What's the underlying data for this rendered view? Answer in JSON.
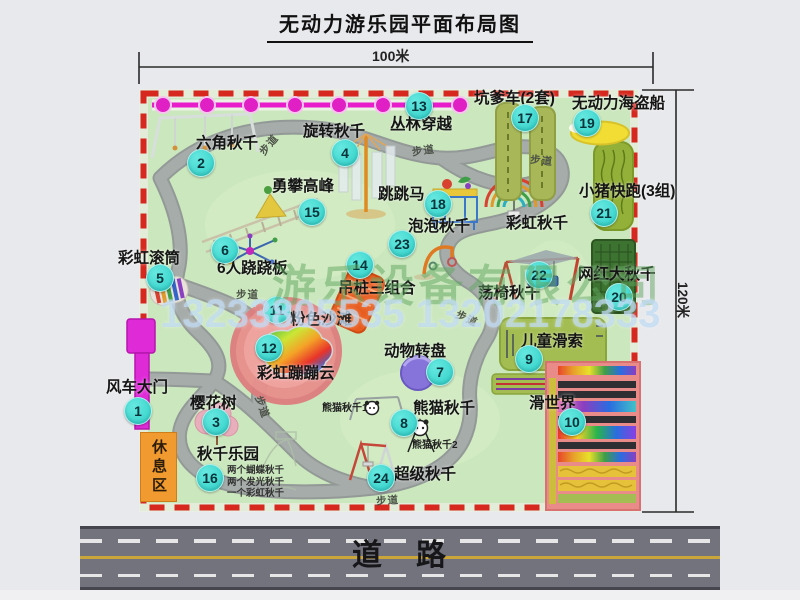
{
  "title": "无动力游乐园平面布局图",
  "dimensions": {
    "width": "100米",
    "height": "120米"
  },
  "road": {
    "label": "道　路"
  },
  "watermarks": {
    "company": "游乐设备有限公司",
    "phones": "13233805535 13202178333"
  },
  "rest_area": {
    "label": "休息区"
  },
  "swing_notes": {
    "x": 227,
    "y": 466,
    "lines": [
      "两个蝴蝶秋千",
      "两个发光秋千",
      "一个彩虹秋千"
    ]
  },
  "small_labels": [
    {
      "text": "熊猫秋千1",
      "x": 322,
      "y": 404
    },
    {
      "text": "熊猫秋千2",
      "x": 412,
      "y": 441
    }
  ],
  "path_labels": [
    {
      "text": "步道",
      "x": 258,
      "y": 140,
      "rot": -50
    },
    {
      "text": "步道",
      "x": 412,
      "y": 146,
      "rot": -8
    },
    {
      "text": "步道",
      "x": 530,
      "y": 156,
      "rot": 6
    },
    {
      "text": "步道",
      "x": 236,
      "y": 290,
      "rot": 0
    },
    {
      "text": "步道",
      "x": 250,
      "y": 402,
      "rot": 70
    },
    {
      "text": "步道",
      "x": 455,
      "y": 314,
      "rot": 25
    },
    {
      "text": "步道",
      "x": 376,
      "y": 496,
      "rot": -4
    }
  ],
  "attractions": [
    {
      "num": "1",
      "name": "风车大门",
      "lx": 106,
      "ly": 380,
      "bx": 137,
      "by": 410
    },
    {
      "num": "2",
      "name": "六角秋千",
      "lx": 196,
      "ly": 136,
      "bx": 200,
      "by": 162
    },
    {
      "num": "3",
      "name": "樱花树",
      "lx": 190,
      "ly": 396,
      "bx": 215,
      "by": 421
    },
    {
      "num": "4",
      "name": "旋转秋千",
      "lx": 303,
      "ly": 124,
      "bx": 344,
      "by": 152
    },
    {
      "num": "5",
      "name": "彩虹滚筒",
      "lx": 118,
      "ly": 251,
      "bx": 159,
      "by": 277
    },
    {
      "num": "6",
      "name": "6人跷跷板",
      "lx": 217,
      "ly": 261,
      "bx": 224,
      "by": 249
    },
    {
      "num": "7",
      "name": "动物转盘",
      "lx": 384,
      "ly": 344,
      "bx": 439,
      "by": 371
    },
    {
      "num": "8",
      "name": "熊猫秋千",
      "lx": 413,
      "ly": 401,
      "bx": 403,
      "by": 422
    },
    {
      "num": "9",
      "name": "儿童滑索",
      "lx": 521,
      "ly": 334,
      "bx": 528,
      "by": 358
    },
    {
      "num": "10",
      "name": "滑世界",
      "lx": 529,
      "ly": 396,
      "bx": 571,
      "by": 421
    },
    {
      "num": "11",
      "name": "粉色沙滩",
      "lx": 290,
      "ly": 312,
      "bx": 276,
      "by": 309
    },
    {
      "num": "12",
      "name": "彩虹蹦蹦云",
      "lx": 257,
      "ly": 366,
      "bx": 268,
      "by": 347
    },
    {
      "num": "13",
      "name": "丛林穿越",
      "lx": 390,
      "ly": 117,
      "bx": 418,
      "by": 105
    },
    {
      "num": "14",
      "name": "吊桩三组合",
      "lx": 338,
      "ly": 281,
      "bx": 359,
      "by": 264
    },
    {
      "num": "15",
      "name": "勇攀高峰",
      "lx": 272,
      "ly": 179,
      "bx": 311,
      "by": 211
    },
    {
      "num": "16",
      "name": "秋千乐园",
      "lx": 197,
      "ly": 447,
      "bx": 209,
      "by": 477
    },
    {
      "num": "17",
      "name": "坑爹车(2套)",
      "lx": 474,
      "ly": 91,
      "bx": 524,
      "by": 117
    },
    {
      "num": "18",
      "name": "跳跳马",
      "lx": 378,
      "ly": 187,
      "bx": 437,
      "by": 203
    },
    {
      "num": "19",
      "name": "无动力海盗船",
      "lx": 572,
      "ly": 96,
      "bx": 586,
      "by": 122
    },
    {
      "num": "20",
      "name": "网红大秋千",
      "lx": 578,
      "ly": 267,
      "bx": 618,
      "by": 296
    },
    {
      "num": "21",
      "name": "小猪快跑(3组)",
      "lx": 579,
      "ly": 184,
      "bx": 603,
      "by": 212
    },
    {
      "num": "22",
      "name": "荡椅秋千",
      "lx": 478,
      "ly": 286,
      "bx": 538,
      "by": 274
    },
    {
      "num": "23",
      "name": "泡泡秋千",
      "lx": 408,
      "ly": 219,
      "bx": 401,
      "by": 243
    },
    {
      "num": "24",
      "name": "超级秋千",
      "lx": 394,
      "ly": 467,
      "bx": 380,
      "by": 477
    },
    {
      "num": null,
      "name": "彩虹秋千",
      "lx": 506,
      "ly": 216
    }
  ],
  "colors": {
    "park_green": "#cbe7bd",
    "border_red": "#d6281e",
    "path_gray": "#a6acaa",
    "badge_cyan": "#2fd0c8",
    "chain_magenta": "#e81ccb",
    "gate_magenta": "#df2ad8",
    "rest_orange": "#f09a30",
    "road_gray": "#72737d",
    "lane_yellow": "#c9a53a",
    "watermark_green": "rgba(95,165,95,0.5)",
    "watermark_blue": "rgba(190,218,244,0.72)"
  }
}
